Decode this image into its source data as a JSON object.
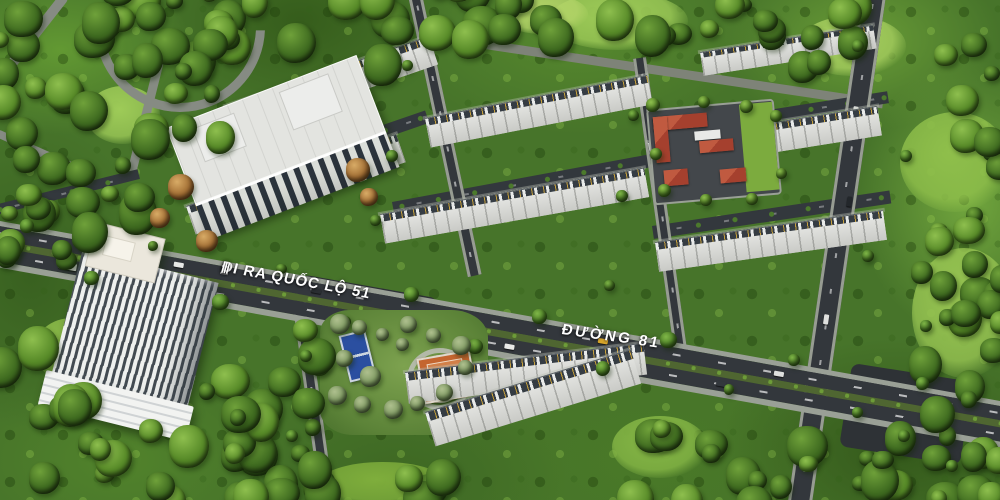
{
  "scene": {
    "title": "Aerial 3D master-plan render of a residential estate",
    "road_labels": {
      "bars": "|||",
      "exit": "ĐI RA QUỐC LỘ 51",
      "street": "ĐƯỜNG 81"
    },
    "landmarks": {
      "highrise": "high-rise apartment tower",
      "midrise": "mid-rise apartment block",
      "school": "red-roofed facility compound",
      "park": "central park with sport courts and spiral plaza",
      "townhouses": "rows of gable-roof townhouses"
    },
    "colors": {
      "forest_dark": "#2c4a1b",
      "forest_mid": "#4a7526",
      "forest_light": "#83b544",
      "roof_light": "#dadbd8",
      "road_dark": "#33373c",
      "school_roof_red": "#a5402e",
      "court_blue": "#2b4fa0",
      "court_orange": "#c4652f",
      "spiral_copper": "#c79165",
      "label_white": "#ffffff"
    }
  }
}
